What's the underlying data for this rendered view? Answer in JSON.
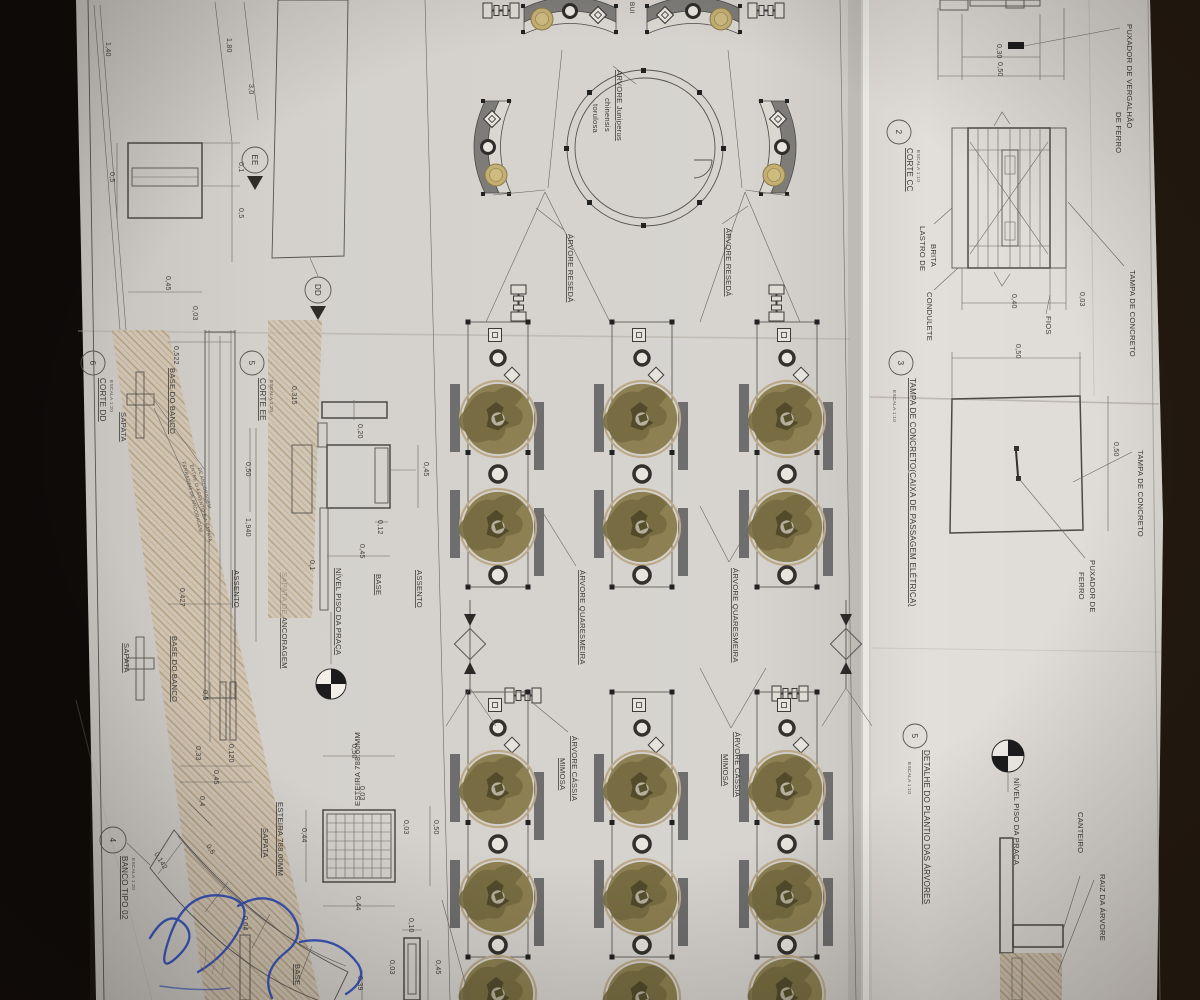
{
  "colors": {
    "paper": "#d6d3cf",
    "paper_right": "#e2dfda",
    "ink": "#4c4a47",
    "canopy": "#8d8052",
    "bench_gray": "#7d7c79",
    "hatch_tan": "#b89d7c",
    "signature_blue": "#2747b8",
    "table_dark": "#191410"
  },
  "callouts": {
    "corte_cc": {
      "num": "2",
      "title": "CORTE CC",
      "scale": "ESCALA 1:10"
    },
    "tampa_caixa": {
      "num": "3",
      "title": "TAMPA DE CONCRETO(CAIXA DE PASSAGEM ELÉTRICA)",
      "scale": "ESCALA 1:10"
    },
    "plantio": {
      "num": "5",
      "title": "DETALHE DO PLANTIO DAS ÁRVORES",
      "scale": "ESCALA 1:10"
    },
    "corte_ee": {
      "num": "5",
      "title": "CORTE EE",
      "scale": "ESCALA 1:20"
    },
    "corte_dd": {
      "num": "6",
      "title": "CORTE DD",
      "scale": "ESCALA 1:20"
    },
    "banco": {
      "num": "4",
      "title": "BANCO TIPO 02",
      "scale": "ESCALA 1:20"
    }
  },
  "markers": {
    "ee": "EE",
    "dd": "DD"
  },
  "labels": {
    "puxador_vergalhao_l1": "PUXADOR DE VERGALHÃO",
    "puxador_vergalhao_l2": "DE FERRO",
    "tampa_concreto": "TAMPA DE CONCRETO",
    "lastro_l1": "LASTRO DE",
    "lastro_l2": "BRITA",
    "condulete": "CONDULETE",
    "fios": "FIOS",
    "tampa_concreto_2": "TAMPA DE CONCRETO",
    "puxador_ferro_l1": "PUXADOR DE",
    "puxador_ferro_l2": "FERRO",
    "nivel_piso": "NÍVEL PISO DA PRAÇA",
    "nivel_piso_2": "NÍVEL PISO DA PRAÇA",
    "canteiro": "CANTEIRO",
    "raiz_arvore": "RAIZ DA ÁRVORE",
    "sapata_1": "SAPATA",
    "sapata_2": "SAPATA",
    "sapata_3": "SAPATA",
    "base_do_banco_1": "BASE DO BANCO",
    "base_do_banco_2": "BASE DO BANCO",
    "assento_dd": "ASSENTO",
    "assento_ee": "ASSENTO",
    "base_ee": "BASE",
    "base_plate": "BASE",
    "sapata_ancoragem": "SAPATA DE ANCORAGEM",
    "ferragem_l1": "FERRAGEM DE ANCORAGEM",
    "ferragem_l2": "ENTRE O ASSENTO E A SAPATA",
    "ferragem_l3": "DE ANCORAGEM",
    "esteira_top": "ESTEIRA 788.00MM",
    "esteira_left": "ESTEIRA 788.00MM",
    "arvore_juniperus_l1": "ÁRVORE Juniperus",
    "arvore_juniperus_l2": "chinensis",
    "arvore_juniperus_l3": "torulosa",
    "arvore_reseda_1": "ÁRVORE RESEDÁ",
    "arvore_reseda_2": "ÁRVORE RESEDÁ",
    "arvore_quaresmeira_1": "ÁRVORE QUARESMEIRA",
    "arvore_quaresmeira_2": "ÁRVORE QUARESMEIRA",
    "arvore_cassia_1a": "ÁRVORE CÁSSIA",
    "arvore_cassia_1b": "MIMOSA",
    "arvore_cassia_2a": "ÁRVORE CÁSSIA",
    "arvore_cassia_2b": "MIMOSA",
    "edge_fragment": "BUI"
  },
  "dims": {
    "walkway": {
      "w140": "1,40",
      "w180": "1,80",
      "w30": "3,0"
    },
    "bench_plan": {
      "left05": "0,5",
      "r01": "0,1",
      "r05": "0,5",
      "b045": "0,45",
      "b003": "0,03"
    },
    "corte_cc": {
      "top030": "0,30",
      "top050": "0,50",
      "bot040": "0,40",
      "bot003": "0,03"
    },
    "tampa": {
      "top050": "0,50",
      "right050": "0,50"
    },
    "corte_dd": {
      "d0522": "0,522",
      "d0427": "0,427",
      "d050": "0,50",
      "d1940": "1,940"
    },
    "corte_ee": {
      "d0315": "0,315",
      "d020": "0,20",
      "d045r": "0,45",
      "d012": "0,12",
      "d045b": "0,45",
      "d01": "0,1"
    },
    "banco": {
      "d04": "0,4",
      "d0142": "0,142",
      "d05": "0,5",
      "d05top": "0,5",
      "d033": "0,33",
      "d0120": "0,120",
      "d045": "0,45"
    },
    "esteira": {
      "top050": "0,50",
      "left044": "0,44",
      "t003": "0,03",
      "r003": "0,03",
      "bot044": "0,44",
      "right050": "0,50"
    },
    "plates": {
      "d004": "0,04",
      "d010": "0,10",
      "d003": "0,03",
      "d039": "0,39",
      "d045": "0,45"
    }
  }
}
